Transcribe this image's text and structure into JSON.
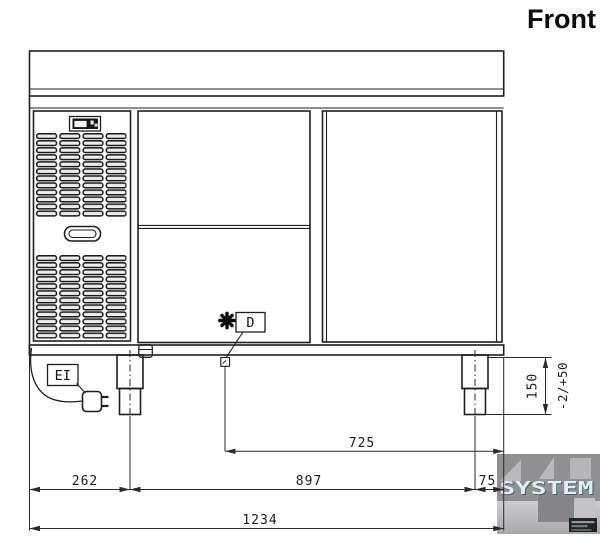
{
  "view_label": "Front",
  "callouts": {
    "electrical_connection": "EI",
    "drain": "D"
  },
  "dimensions_mm": {
    "left_section_width": "262",
    "middle_section_width": "897",
    "right_section_width": "75",
    "overall_width": "1234",
    "drain_offset": "725",
    "leg_height": "150",
    "leg_height_tolerance": "-2/+50"
  },
  "icons": {
    "drain_marker": "star-burst-icon",
    "power_plug": "power-plug-icon"
  },
  "watermark": {
    "text": "SYSTEM"
  },
  "colors": {
    "line": "#1f1f1f",
    "dimension": "#2a2a2a",
    "background": "#ffffff",
    "watermark_bg": "#909092",
    "watermark_text": "#dbeff6"
  }
}
